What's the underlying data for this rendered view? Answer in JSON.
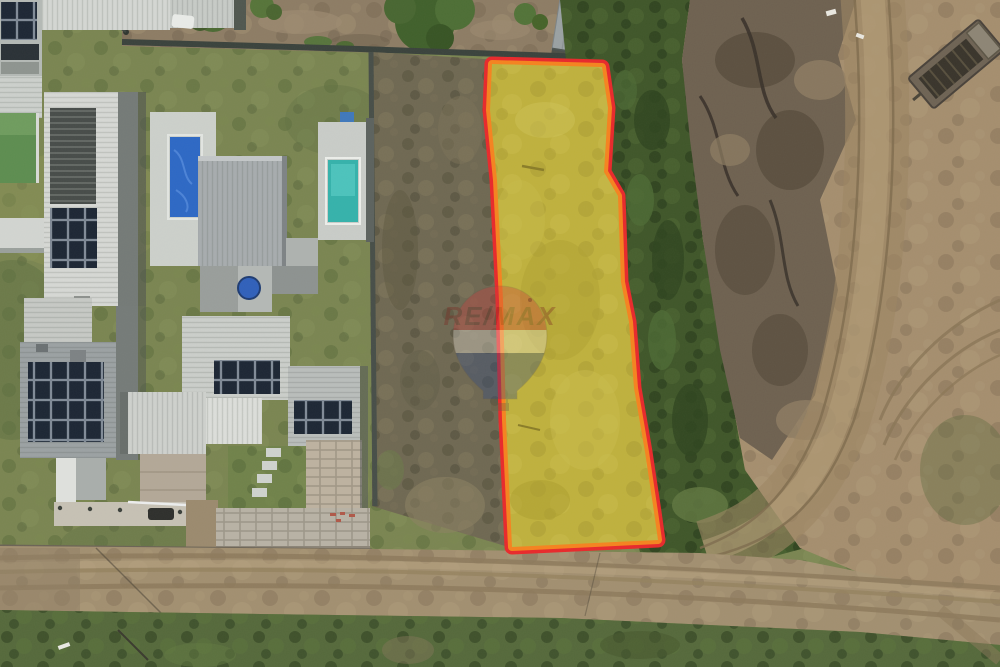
{
  "image": {
    "kind": "aerial-drone-photograph",
    "description": "Top-down drone photo of a vacant residential land lot highlighted in yellow with a red and orange boundary, beside modern houses with solar panels and swimming pools, a scrub strip, dark vegetation, an earthworks dirt stockpile with truck tracks and a dump truck, and a dirt road with grass below. Semi-transparent RE/MAX balloon watermark in the center.",
    "watermark": {
      "text": "RE/MAX",
      "opacity": "0.34"
    },
    "highlight": {
      "lot_fill": "#bfb13d",
      "outline_outer": "#e8292b",
      "outline_inner": "#f5831f"
    },
    "balloon": {
      "top": "#cf3a3c",
      "band": "#efeae0",
      "bottom": "#2c4784",
      "text_color": "#7c241d",
      "basket": "#6b5a40"
    },
    "terrain": {
      "grass": "#7a8551",
      "scrub": "#6f6852",
      "dark_vegetation": "#3f5629",
      "yard_dirt": "#8d7c64",
      "earthworks_dirt": "#a58e6e",
      "mound_dark": "#6e6150",
      "road": "#a28f70",
      "bottom_grass": "#55693b"
    },
    "buildings": {
      "roof_white": "#d6d8d4",
      "roof_gray": "#a7acae",
      "roof_light_gray": "#cbceca",
      "solar_panel": "#1c2634",
      "pool_cover_blue": "#2d68c5",
      "pool_water_teal": "#35b2ab",
      "green_pool": "#5d8d50"
    },
    "vehicle": {
      "truck_bed": "#6e6354"
    }
  }
}
